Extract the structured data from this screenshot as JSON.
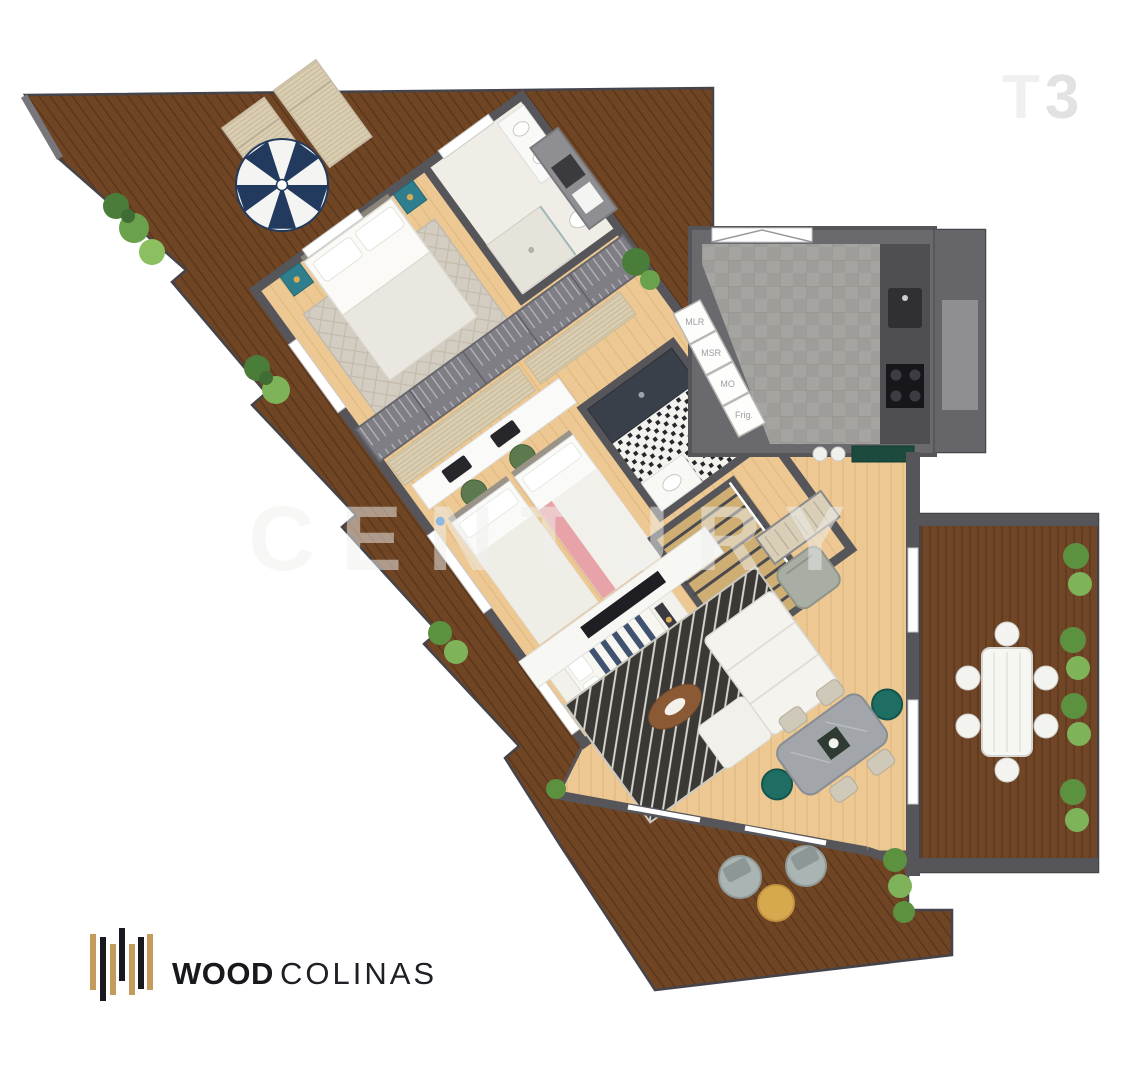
{
  "plan_label": {
    "t": "T",
    "three": "3",
    "color_t": "#f0f0f0",
    "color_3": "#e2e2e2"
  },
  "watermark": {
    "text": "CENTURY"
  },
  "logo": {
    "word_bold": "WOOD",
    "word_light": "COLINAS",
    "bar_tan": "#c49b5c",
    "bar_black": "#17191e"
  },
  "kitchen": {
    "appliance_labels": [
      "MLR",
      "MSR",
      "MO",
      "Frig."
    ]
  },
  "palette": {
    "deck_wood": "#6f4524",
    "deck_wood_line": "#55331b",
    "interior_wood": "#edc893",
    "interior_wood_line": "#dcb87e",
    "wall": "#55555a",
    "kitchen_tile": "#a5a4a0",
    "teal_accent": "#2e7e8e",
    "umbrella_navy": "#223a5e",
    "plant_green": "#5c9140",
    "dining_teal_chair": "#1f6e63",
    "console_green": "#1c4a3e"
  }
}
